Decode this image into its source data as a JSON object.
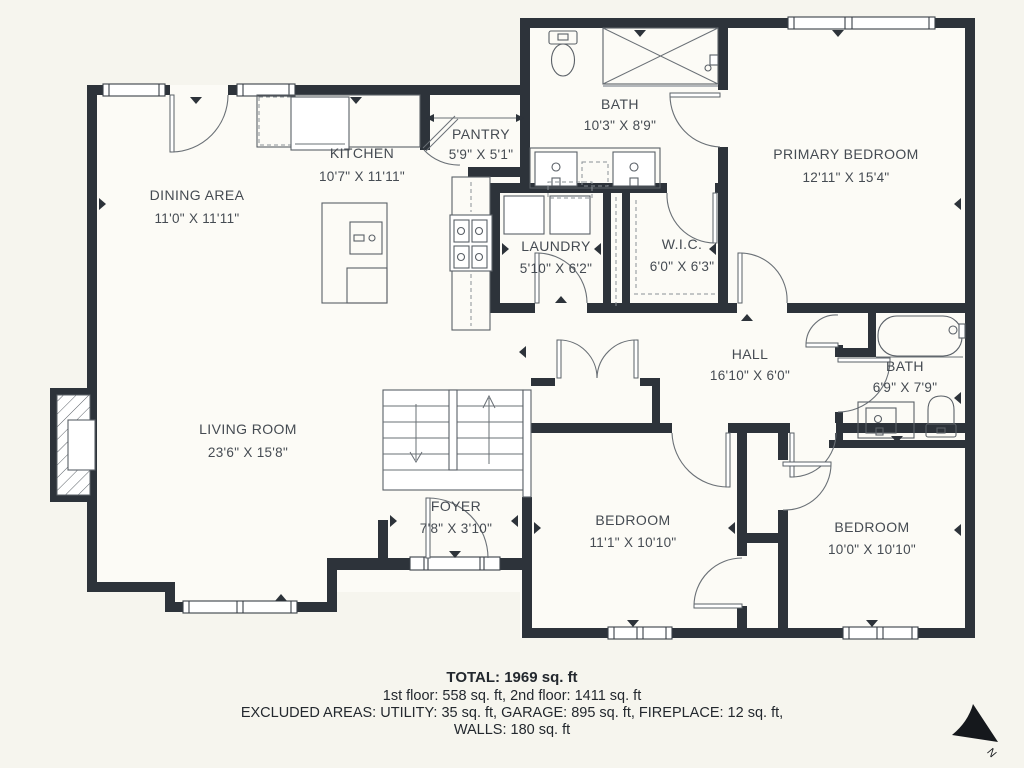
{
  "rooms": [
    {
      "name": "DINING AREA",
      "dims": "11'0\" X 11'11\""
    },
    {
      "name": "KITCHEN",
      "dims": "10'7\" X 11'11\""
    },
    {
      "name": "PANTRY",
      "dims": "5'9\" X 5'1\""
    },
    {
      "name": "BATH",
      "dims": "10'3\" X 8'9\""
    },
    {
      "name": "PRIMARY BEDROOM",
      "dims": "12'11\" X 15'4\""
    },
    {
      "name": "LAUNDRY",
      "dims": "5'10\" X 6'2\""
    },
    {
      "name": "W.I.C.",
      "dims": "6'0\" X 6'3\""
    },
    {
      "name": "HALL",
      "dims": "16'10\" X 6'0\""
    },
    {
      "name": "BATH",
      "dims": "6'9\" X 7'9\""
    },
    {
      "name": "LIVING ROOM",
      "dims": "23'6\" X 15'8\""
    },
    {
      "name": "FOYER",
      "dims": "7'8\" X 3'10\""
    },
    {
      "name": "BEDROOM",
      "dims": "11'1\" X 10'10\""
    },
    {
      "name": "BEDROOM",
      "dims": "10'0\" X 10'10\""
    }
  ],
  "footer": {
    "total": "TOTAL: 1969 sq. ft",
    "floors": "1st floor: 558 sq. ft, 2nd floor: 1411 sq. ft",
    "excluded": "EXCLUDED AREAS: UTILITY: 35 sq. ft, GARAGE: 895 sq. ft, FIREPLACE: 12 sq. ft,",
    "walls": "WALLS: 180 sq. ft"
  },
  "compass": {
    "label": "N"
  },
  "colors": {
    "wall": "#2d333a",
    "background": "#f6f5ee",
    "floor": "#fcfbf6",
    "text": "#454b52"
  }
}
